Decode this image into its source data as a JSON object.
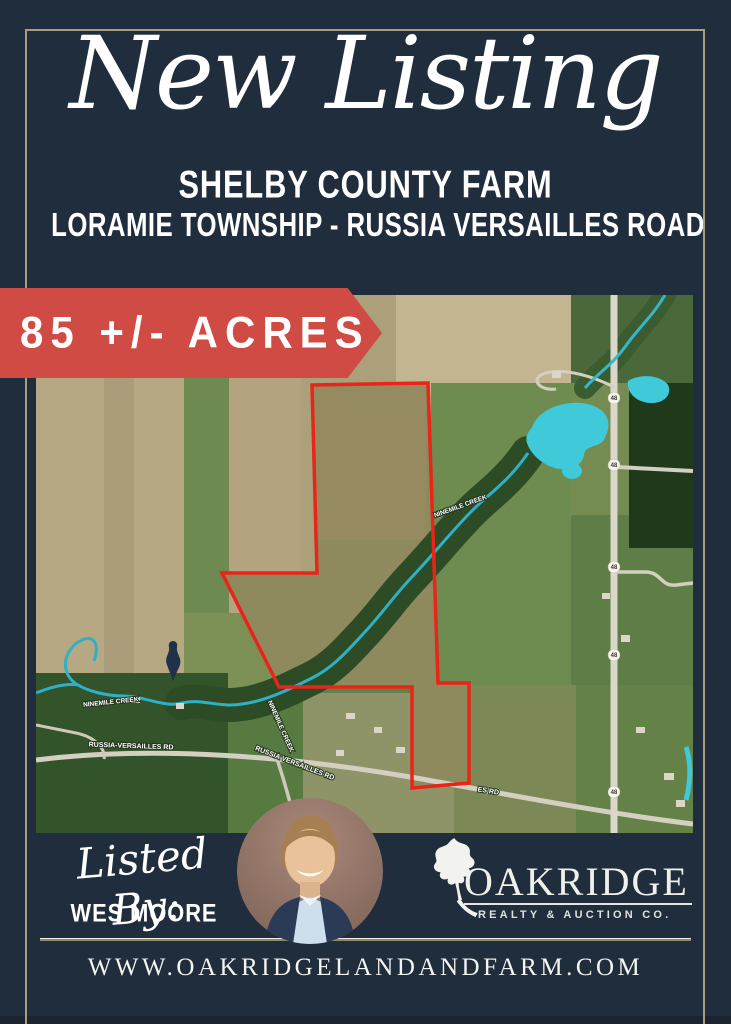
{
  "poster": {
    "title_script": "New Listing",
    "heading": "SHELBY COUNTY FARM",
    "subheading": "LORAMIE TOWNSHIP - RUSSIA VERSAILLES ROAD",
    "acreage_banner": "85 +/- ACRES",
    "listed_by_label": "Listed By:",
    "agent_name": "WES MOORE",
    "brokerage_name": "OAKRIDGE",
    "brokerage_tagline": "REALTY & AUCTION CO.",
    "website": "WWW.OAKRIDGELANDANDFARM.COM"
  },
  "map": {
    "creek_label_1": "NINEMILE CREEK",
    "creek_label_2": "NINEMILE CREEK",
    "creek_label_3": "NINEMILE CREEK",
    "road_label_1": "RUSSIA-VERSAILLES RD",
    "road_label_2": "RUSSIA VERSAILLES RD",
    "road_label_3": "ES RD",
    "route_marker": "48"
  },
  "icons": {
    "oak_leaf": "oak-leaf-icon",
    "agent_photo": "agent-photo"
  },
  "colors": {
    "background_navy": "#1f2d3d",
    "frame_tan": "#a89c82",
    "banner_red": "#d04b43",
    "boundary_red": "#ea2418",
    "water_cyan": "#3fc9d9",
    "text_white": "#ffffff"
  }
}
